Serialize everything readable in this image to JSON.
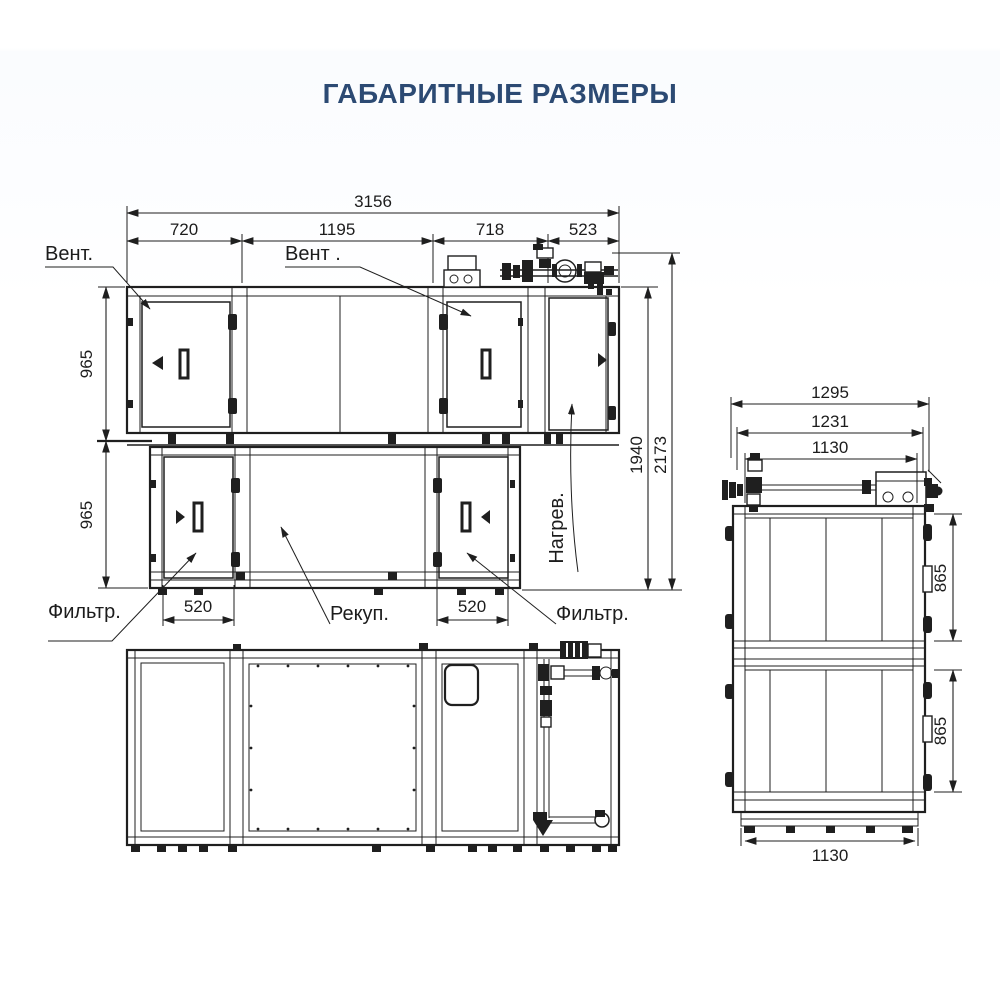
{
  "title": "ГАБАРИТНЫЕ РАЗМЕРЫ",
  "colors": {
    "accent": "#2c4a73",
    "line": "#1f1f1f",
    "background": "#ffffff"
  },
  "front_view": {
    "dims": {
      "overall_width": "3156",
      "sections": [
        "720",
        "1195",
        "718",
        "523"
      ],
      "upper_height": "965",
      "lower_height": "965",
      "body_height": "1940",
      "total_height": "2173",
      "filter_left_width": "520",
      "filter_right_width": "520"
    },
    "labels": {
      "fan_left": "Вент.",
      "fan_right": "Вент .",
      "filter_left": "Фильтр.",
      "filter_right": "Фильтр.",
      "recuperator": "Рекуп.",
      "heater": "Нагрев."
    }
  },
  "side_view": {
    "dims": {
      "overall_depth": "1295",
      "frame_depth": "1231",
      "panel_depth": "1130",
      "upper_height": "865",
      "lower_height": "865",
      "base_depth": "1130"
    }
  }
}
